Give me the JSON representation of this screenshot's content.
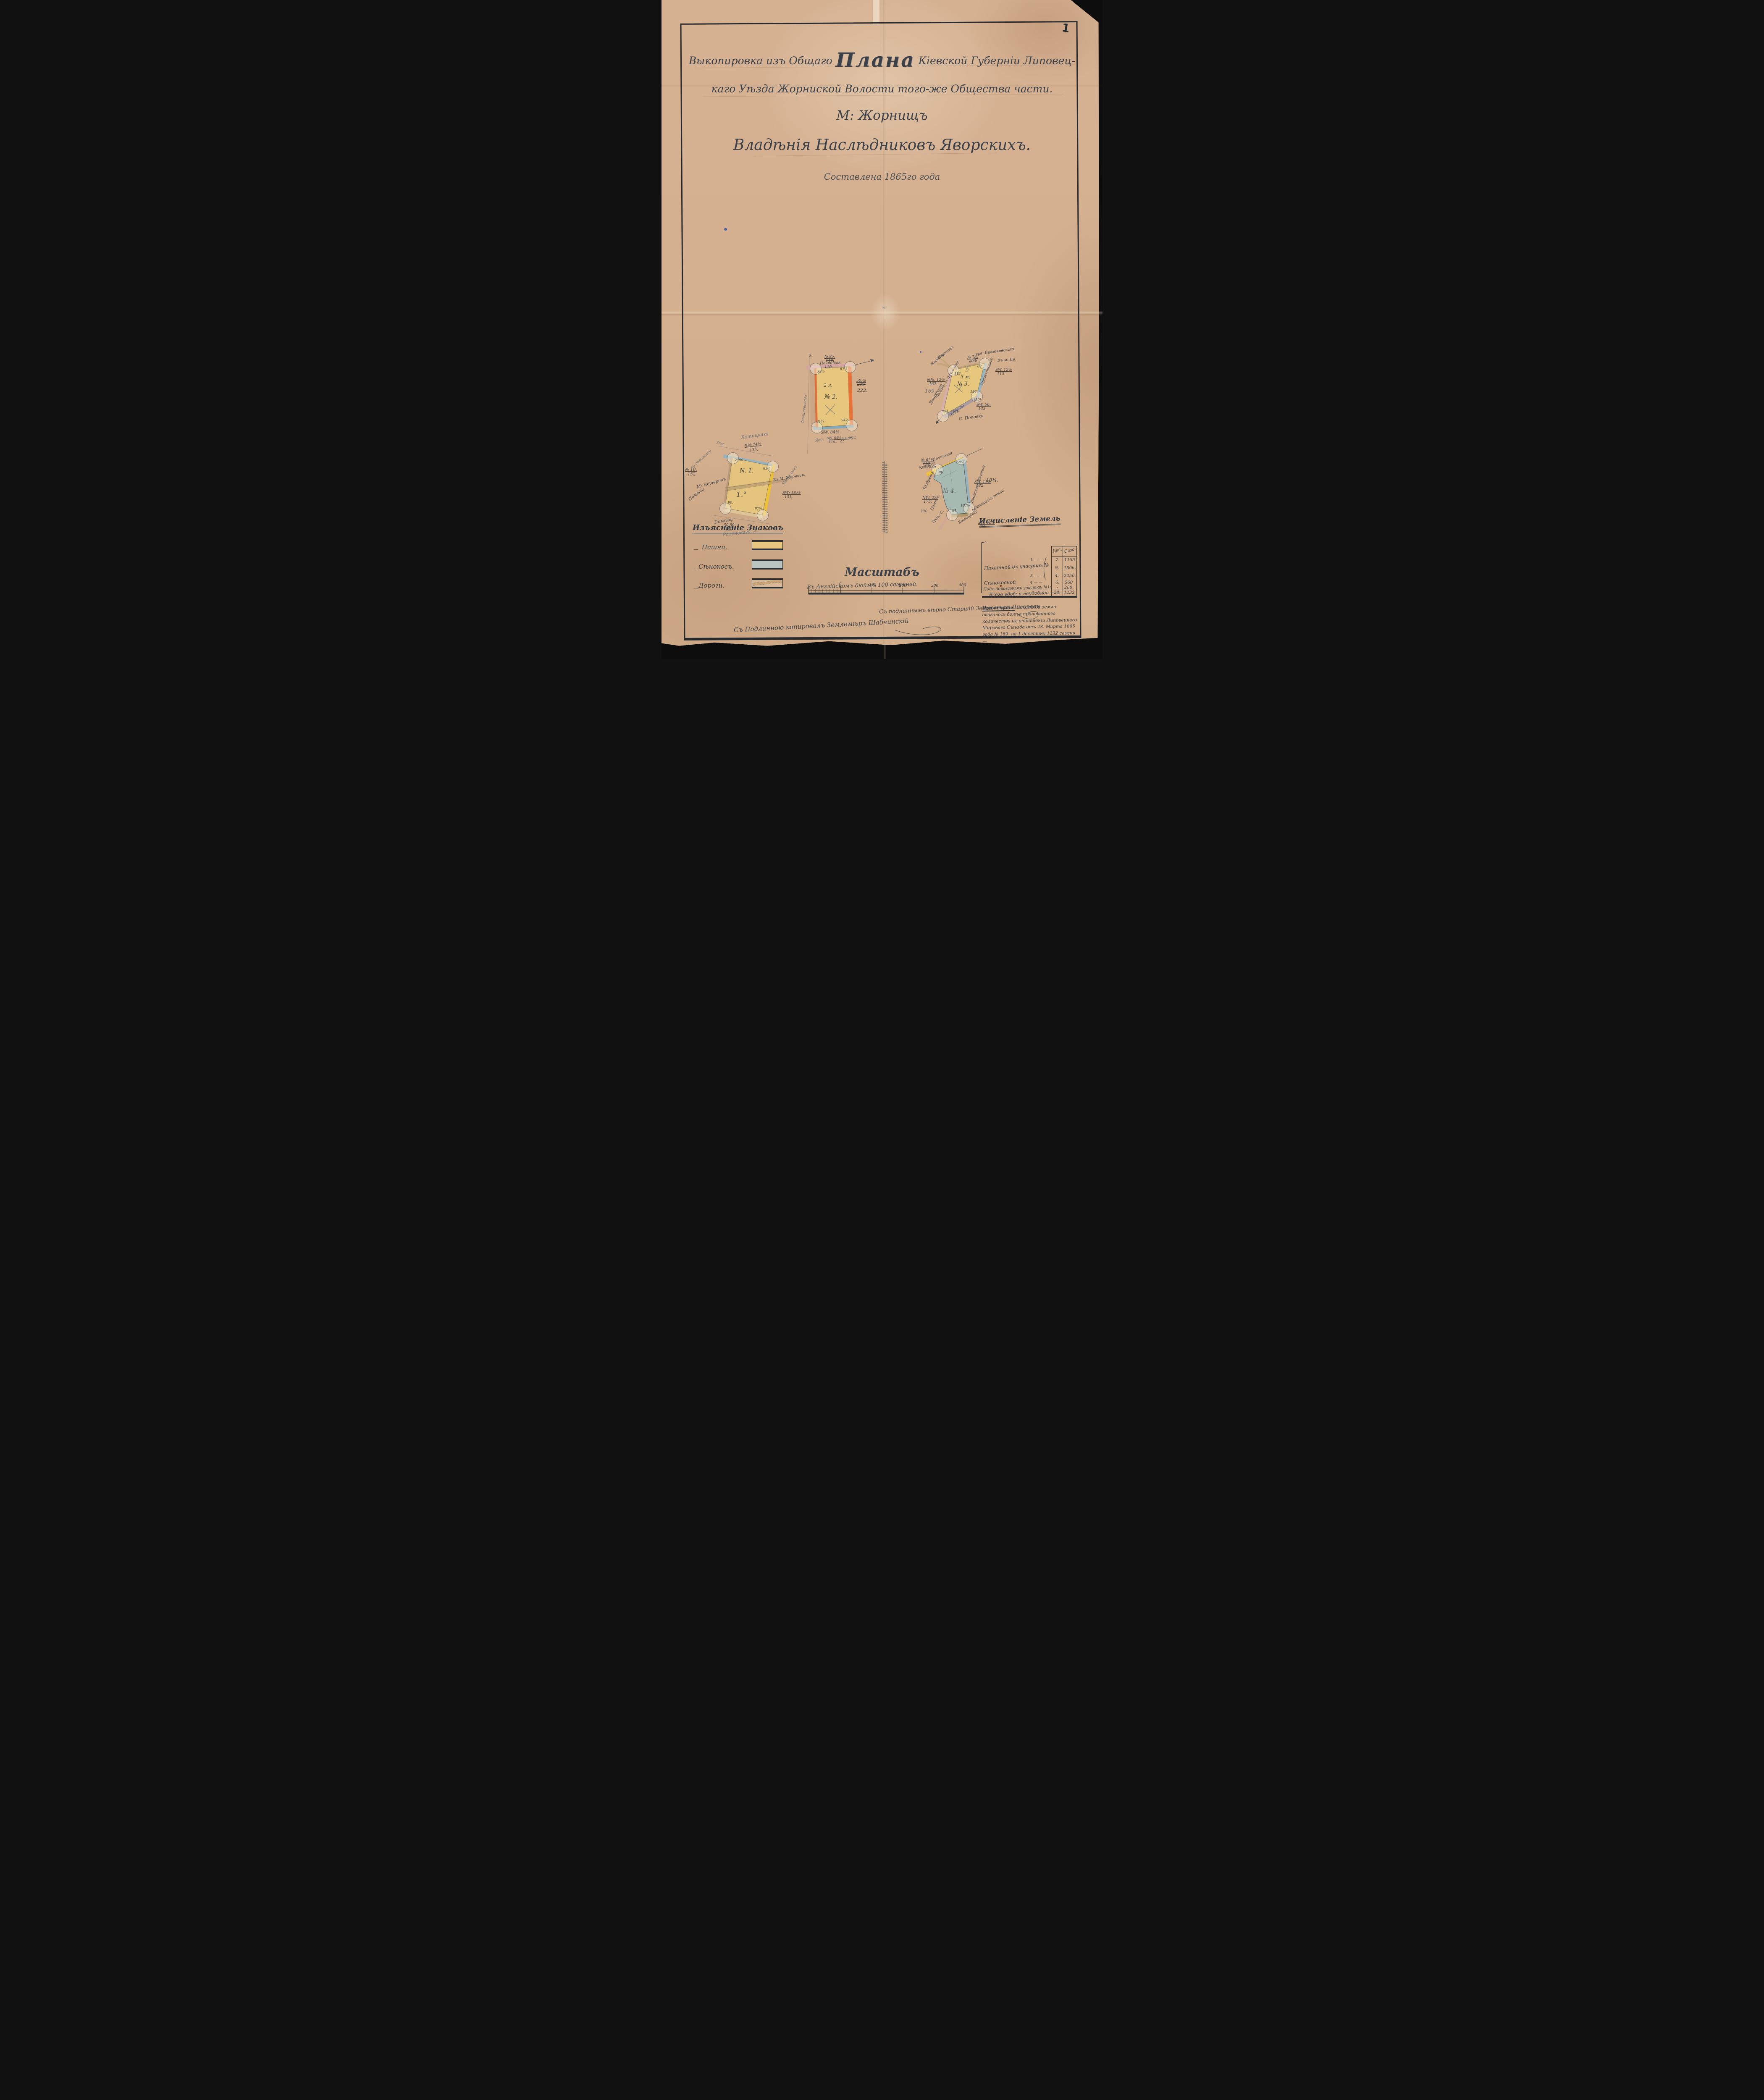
{
  "page": {
    "number": "1",
    "fold_mark": "№"
  },
  "title": {
    "line1_pre": "Выкопировка изъ Общаго",
    "line1_word": "Плана",
    "line1_post": "Кіевской Губерніи Липовец-",
    "line2": "каго Уѣзда Жорниской Волости того-же Общества части.",
    "line3": "М: Жорнищъ",
    "line4": "Владѣнія Наслѣдниковъ Яворскихъ.",
    "line5": "Составлена 1865го года"
  },
  "parcels": [
    {
      "label": "N. 1.",
      "pencil_label": "1.°",
      "angles": [
        "89¼",
        "83¼",
        "90.",
        "97½"
      ],
      "annotations": [
        "Хотицкаго",
        "Зем:",
        "№№ 74½",
        "135.",
        "№ 10.",
        "152",
        "М: Нешеровъ",
        "Помѣщ:",
        "по дорожной",
        "Въ М: Жорнища",
        "Яворскаго",
        "SW: 18.½",
        "151.",
        "Помѣщ:",
        "50.80",
        "120.",
        "З",
        "Раленскаго."
      ]
    },
    {
      "label": "№ 2.",
      "pencil_label": "2 л.",
      "angles": [
        "93½",
        "87½",
        "84¾",
        "94½"
      ],
      "annotations": [
        "№ 85.",
        "148.",
        "Почтовая",
        "110.",
        "з",
        "50.½",
        "230.",
        "222.",
        "Фамилевскаго",
        "SW. 84½.",
        "SW. 84½ въ м",
        "110.",
        "Яво:",
        "С",
        "жс"
      ]
    },
    {
      "label": "№ 3.",
      "pencil_label": "3 м.",
      "angles": [
        "113.",
        "67.",
        "186",
        "44."
      ],
      "annotations": [
        "№ 78.",
        "103.",
        "кре: Бражковскаго",
        "Въ м: Ив:",
        "Жорнищъ",
        "Жорнища",
        "№№. 12½",
        "167.",
        "169.",
        "Яворскаго",
        "Помѣщ: съ Дел: и мѣр",
        "SW. 12½",
        "115.",
        "Бражковскаго",
        "Мо:",
        "SW. 56.",
        "133.",
        "казен:",
        "Поля",
        "С. Поповки",
        "100"
      ]
    },
    {
      "label": "№ 4.",
      "angles": [
        "96.",
        "72½",
        "84.",
        "107½"
      ],
      "annotations": [
        "№ 62½",
        "110",
        "108.6:",
        "Почтовая",
        "Крестъ:",
        "SW. 11½",
        "182.",
        "18¾.",
        "NW: 22.",
        "175.",
        "100.",
        "SW. 62½",
        "70.",
        "Яворскаго Жорнищ:",
        "помѣщичьи земли",
        "Хотицкаго",
        "Удобренія",
        "Помѣщ:",
        "Троц: С."
      ]
    }
  ],
  "legend": {
    "title": "Изъясненіе Знаковъ",
    "dash": "—",
    "items": [
      {
        "label": "Пашни."
      },
      {
        "label": "Сѣнокосъ."
      },
      {
        "label": "Дороги."
      }
    ],
    "colors": {
      "arable": "#e7c77d",
      "hayfield": "#b9c5be",
      "road": "#c9a06e"
    }
  },
  "table": {
    "title": "Исчисленіе Земель",
    "col_des": "Дес.",
    "col_saj": "Саж.",
    "group_label": "Пахатной въ участкѣ №",
    "sub_rows": [
      {
        "n": "1 — —",
        "des": "7.",
        "saj": "1156."
      },
      {
        "n": "2 — —",
        "des": "9.",
        "saj": "1806."
      },
      {
        "n": "3 — —",
        "des": "4.",
        "saj": "2250."
      }
    ],
    "rows": [
      {
        "label": "Сѣнокосной",
        "n": "4 — —",
        "des": "6.",
        "saj": "560"
      },
      {
        "label": "Подъ дорогами въ участкѣ №1:",
        "n": "— —",
        "des": "·",
        "saj": "260."
      },
      {
        "label": "Всего удоб: и неудобной —",
        "des": "28.",
        "saj": "1232"
      }
    ]
  },
  "note": {
    "label": "Примечаніе:",
    "text": " Пахатной земли оказалось болѣе прописаннаго количества въ отношеніи Липовецкаго Мироваго Съѣзда отъ 23. Марта 1865 года № 169. на 1 десятину 1232 сажни —"
  },
  "scale": {
    "title": "Масштабъ",
    "caption": "Въ Англійскомъ дюймѣ 100 саженей.",
    "ticks": [
      "0",
      "100",
      "200",
      "300",
      "400."
    ]
  },
  "signatures": {
    "certify": "Съ подлиннымъ вѣрно Старшій Землемѣръ Лисоревъ",
    "copy": "Съ Подлинною копировалъ Землемѣръ Шабчинскій"
  }
}
